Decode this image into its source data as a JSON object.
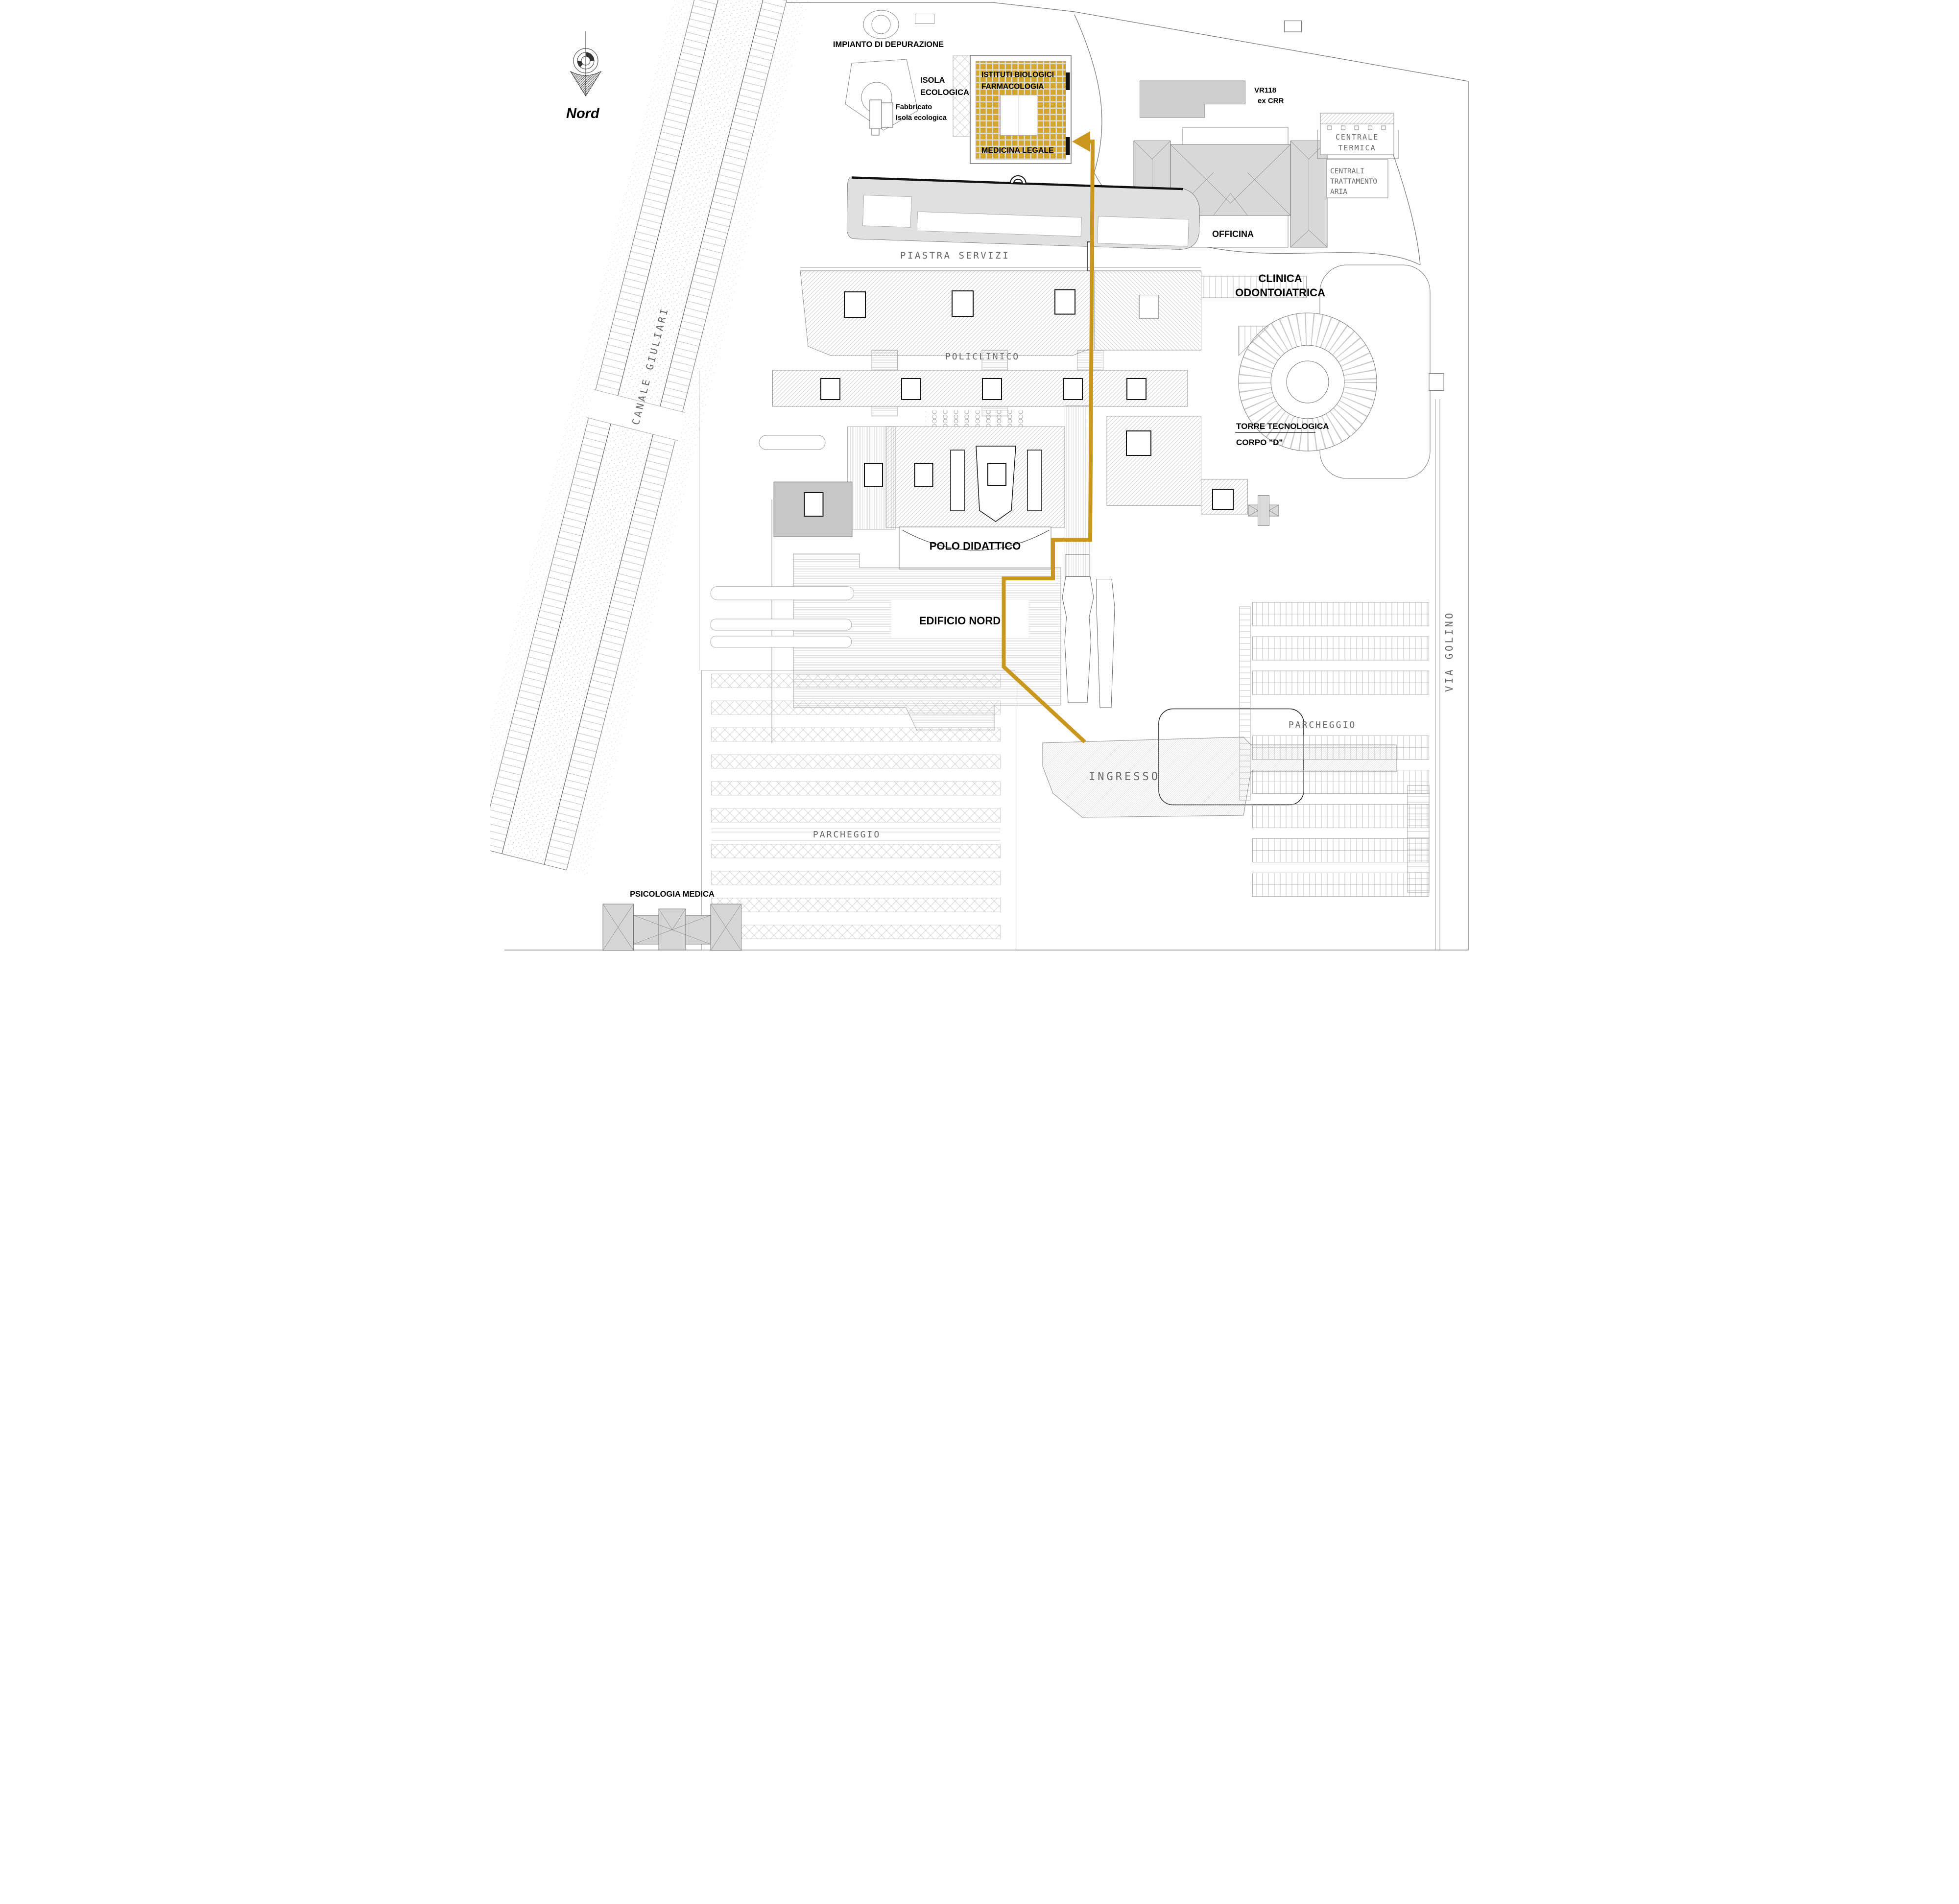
{
  "title": "Campus site plan with route to Istituti Biologici",
  "compass": {
    "label": "Nord"
  },
  "labels": {
    "impianto": "IMPIANTO DI DEPURAZIONE",
    "isola1": "ISOLA",
    "isola2": "ECOLOGICA",
    "fabbricato1": "Fabbricato",
    "fabbricato2": "Isola ecologica",
    "istituti1": "ISTITUTI BIOLOGICI",
    "istituti2": "FARMACOLOGIA",
    "medicina": "MEDICINA LEGALE",
    "vr118_1": "VR118",
    "vr118_2": "ex CRR",
    "officina": "OFFICINA",
    "centrale1": "CENTRALE",
    "centrale2": "TERMICA",
    "centrali1": "CENTRALI",
    "centrali2": "TRATTAMENTO",
    "centrali3": "ARIA",
    "canale": "CANALE GIULIARI",
    "piastra": "PIASTRA SERVIZI",
    "clinica1": "CLINICA",
    "clinica2": "ODONTOIATRICA",
    "policlinico": "POLICLINICO",
    "torre1": "TORRE TECNOLOGICA",
    "torre2": "CORPO \"D\"",
    "polo": "POLO DIDATTICO",
    "edificio": "EDIFICIO NORD",
    "ingresso": "INGRESSO",
    "parcheggio_right": "PARCHEGGIO",
    "parcheggio_bottom": "PARCHEGGIO",
    "psicologia": "PSICOLOGIA MEDICA",
    "via_golino": "VIA GOLINO"
  },
  "colors": {
    "highlight_tile": "#D3A72E",
    "tile_grout": "#DCDCDC",
    "route": "#C9971E",
    "building_gray": "#DFDFDF",
    "building_gray_dark": "#C7C7C7",
    "outline": "#666666",
    "cad_text": "#666666"
  }
}
